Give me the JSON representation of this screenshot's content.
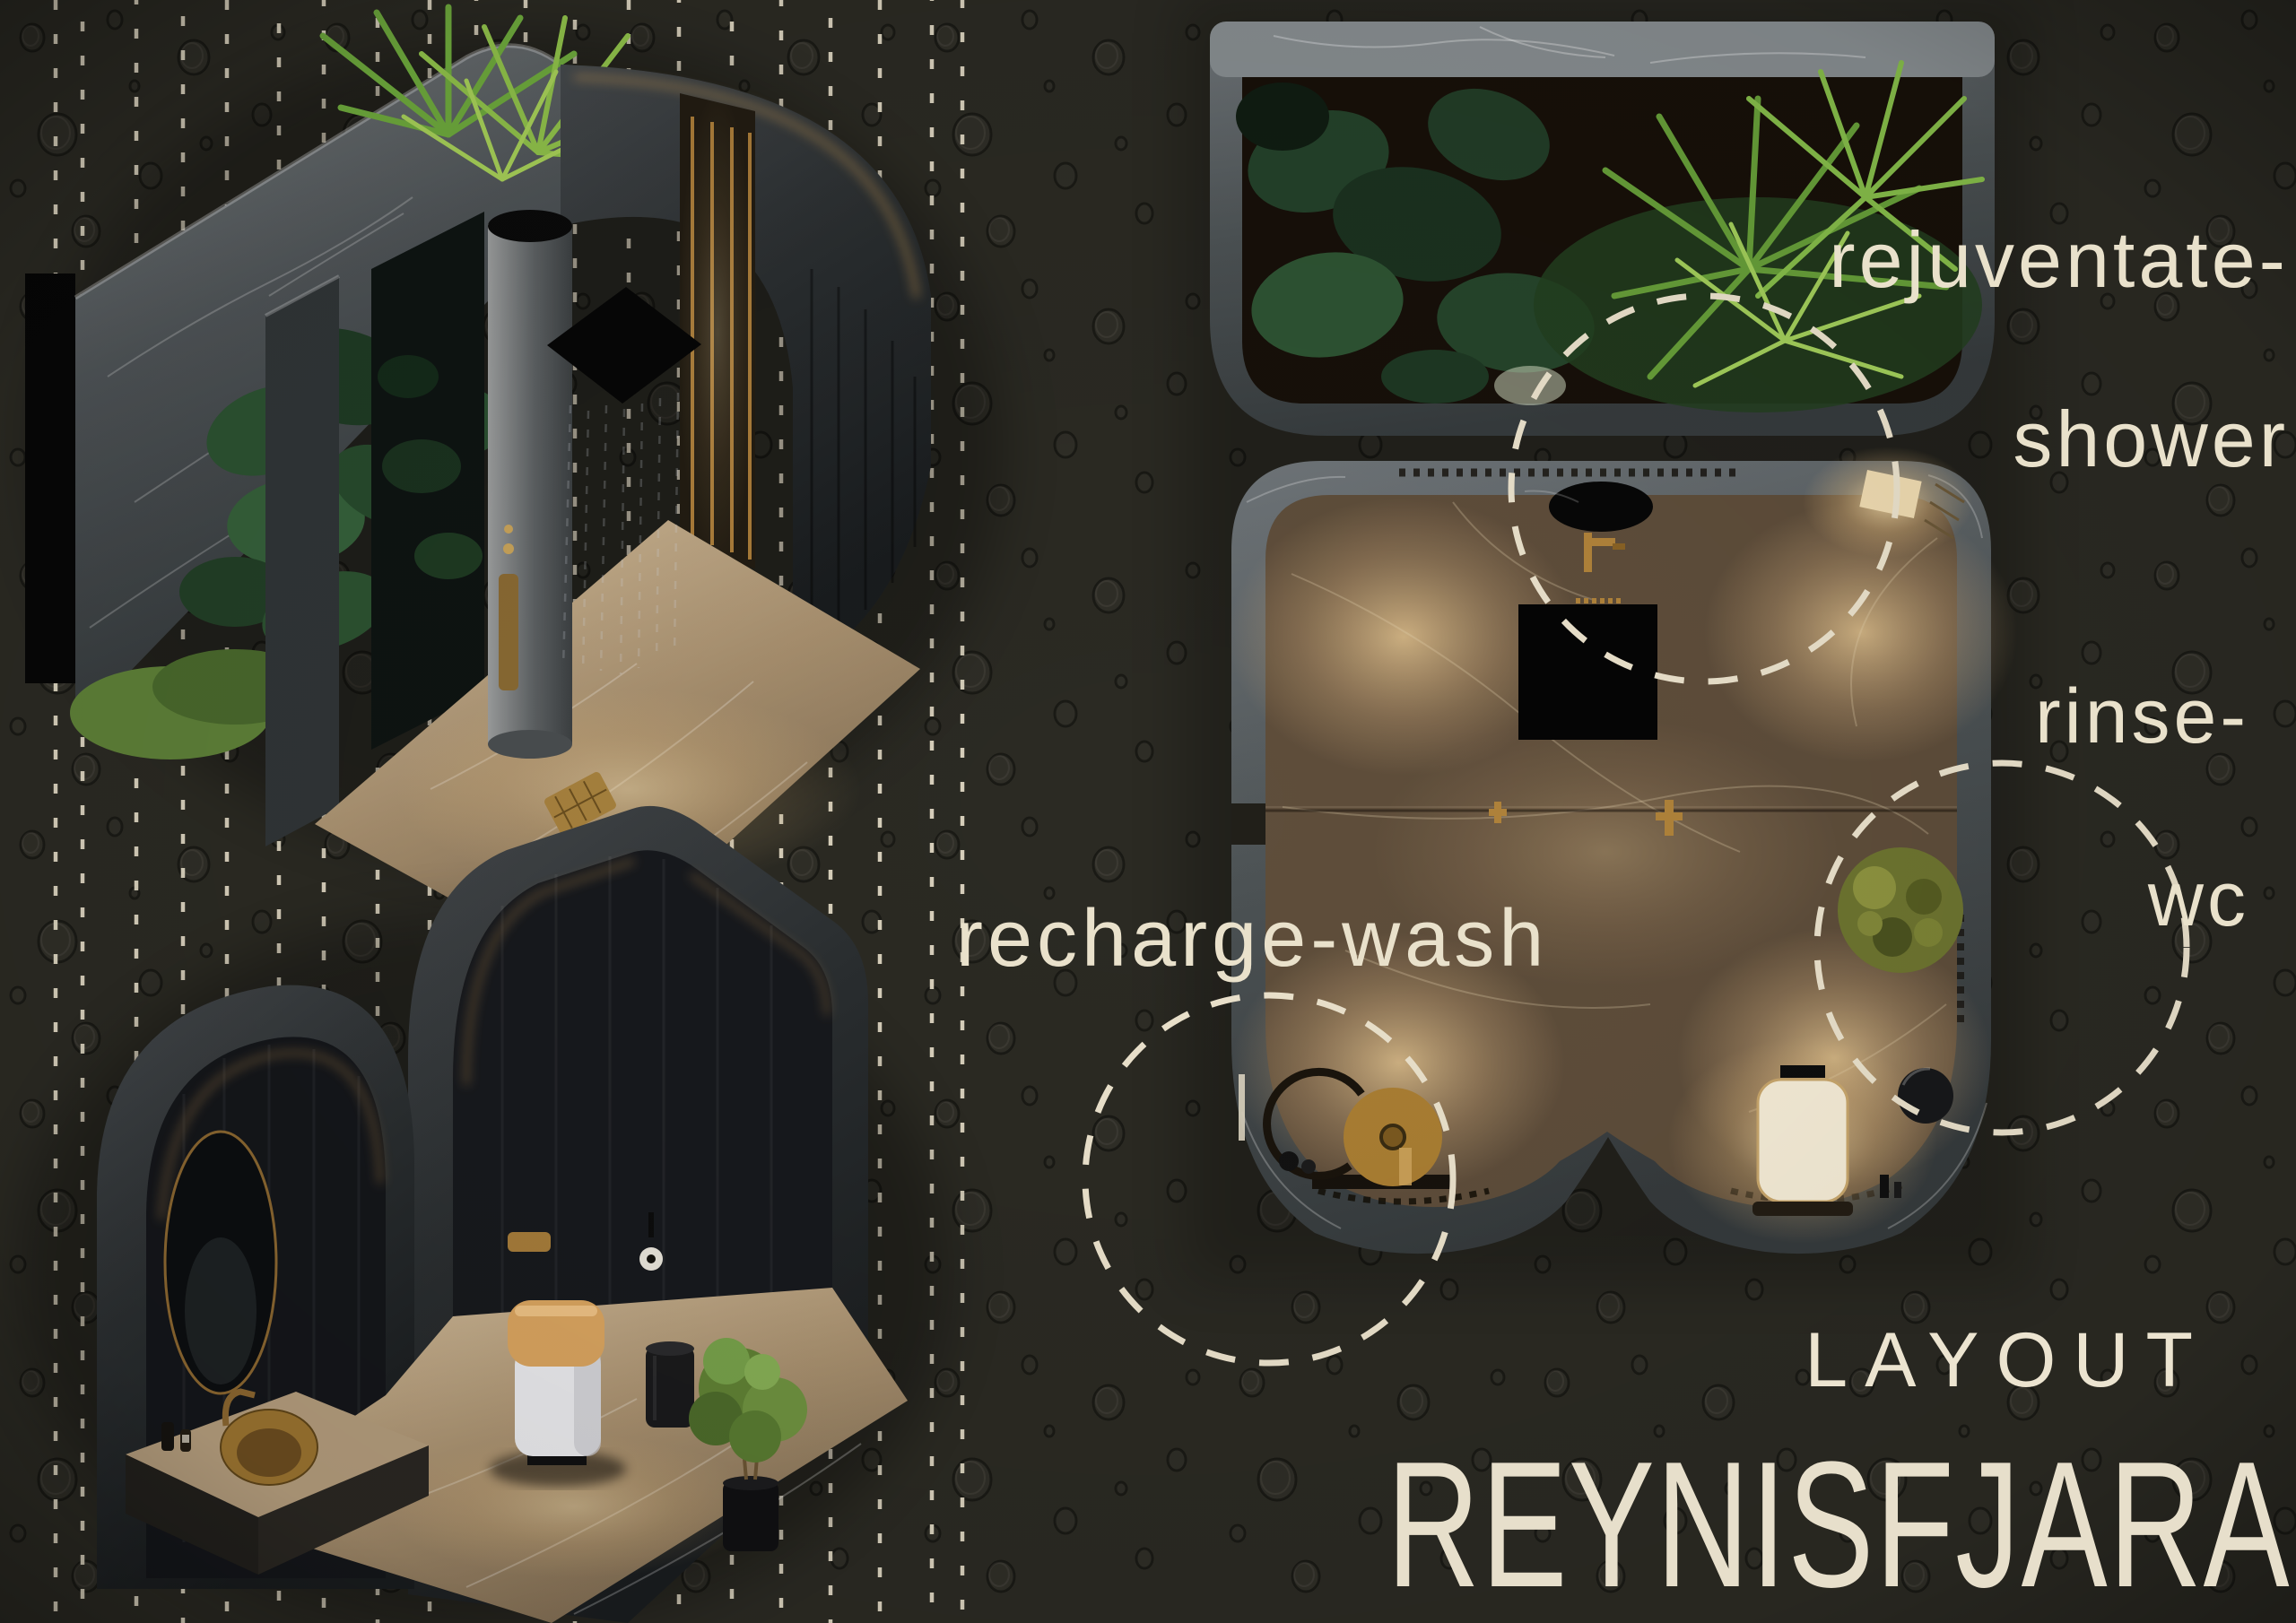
{
  "poster": {
    "annotations": {
      "shower": {
        "line1": "rejuventate-",
        "line2": "shower"
      },
      "wc": {
        "line1": "rinse-",
        "line2": "wc"
      },
      "wash": {
        "label": "recharge-wash"
      }
    },
    "footer": {
      "kicker": "LAYOUT",
      "title": "REYNISFJARA"
    },
    "colors": {
      "background": "#2b2a23",
      "label_cream": "#e9e1cb",
      "dash_cream": "#ece3cd",
      "marble_grey": "#565b5d",
      "marble_black": "#26292b",
      "floor_beige": "#b59e7d",
      "plan_floor_brown": "#6b5944",
      "gold": "#b08435",
      "plant_green_bright": "#86bd4a",
      "plant_green_dark": "#24422a"
    }
  }
}
